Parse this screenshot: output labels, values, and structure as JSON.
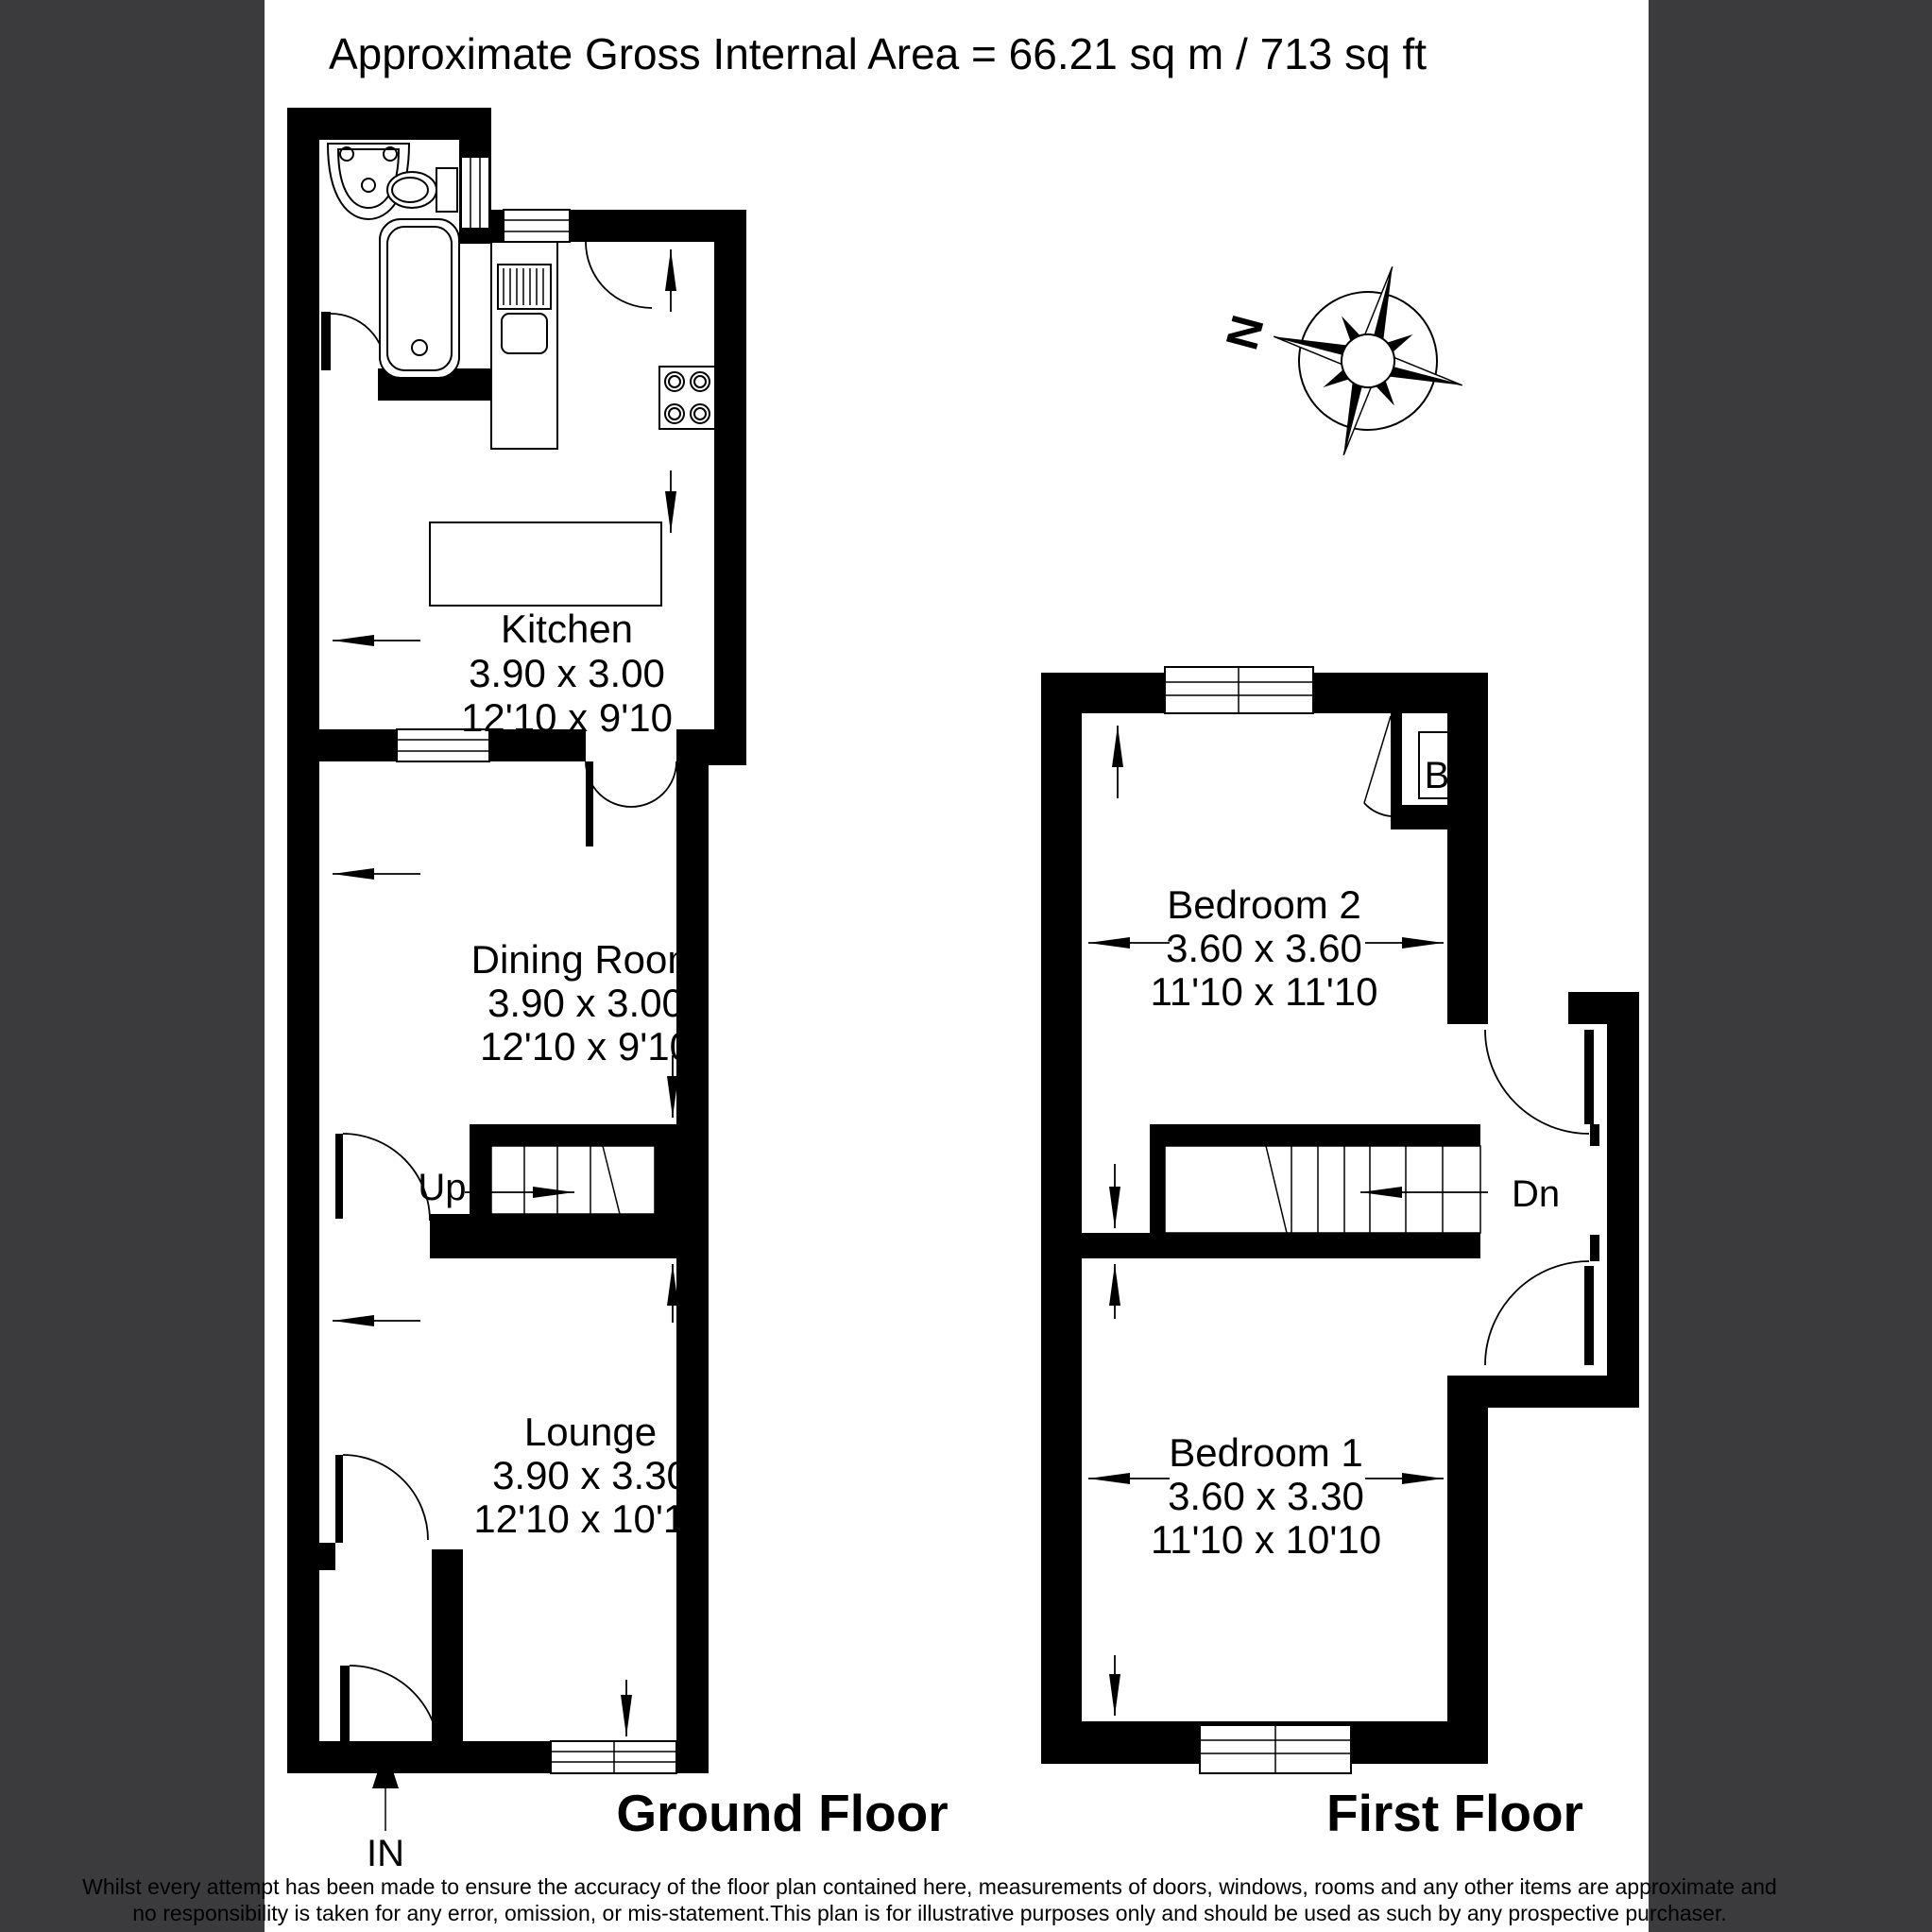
{
  "page": {
    "background": "#ffffff",
    "side_band_color": "#3b3b3d",
    "wall_color": "#000000"
  },
  "title": "Approximate Gross Internal Area = 66.21 sq m / 713 sq ft",
  "compass": {
    "north_label": "N"
  },
  "icons": {
    "compass_rose": "8-point-star",
    "entrance_arrow": "filled-up-arrow",
    "dimension_arrow": "thin-cad-arrow"
  },
  "ground_floor": {
    "label": "Ground Floor",
    "entrance_label": "IN",
    "stairs_label": "Up",
    "rooms": {
      "kitchen": {
        "name": "Kitchen",
        "size_metric": "3.90 x 3.00",
        "size_imperial": "12'10 x 9'10"
      },
      "dining_room": {
        "name": "Dining Room",
        "size_metric": "3.90 x 3.00",
        "size_imperial": "12'10 x 9'10"
      },
      "lounge": {
        "name": "Lounge",
        "size_metric": "3.90 x 3.30",
        "size_imperial": "12'10 x 10'10"
      }
    }
  },
  "first_floor": {
    "label": "First Floor",
    "stairs_label": "Dn",
    "boiler_label": "B",
    "rooms": {
      "bedroom_2": {
        "name": "Bedroom 2",
        "size_metric": "3.60 x 3.60",
        "size_imperial": "11'10 x 11'10"
      },
      "bedroom_1": {
        "name": "Bedroom 1",
        "size_metric": "3.60 x 3.30",
        "size_imperial": "11'10 x 10'10"
      }
    }
  },
  "disclaimer": {
    "line1": "Whilst every attempt has been made to ensure the accuracy of the floor plan contained here, measurements of doors, windows, rooms and any other items are approximate and",
    "line2": "no responsibility is taken for any error, omission, or mis-statement.This plan is for illustrative purposes only and should be used as such by any prospective purchaser."
  }
}
